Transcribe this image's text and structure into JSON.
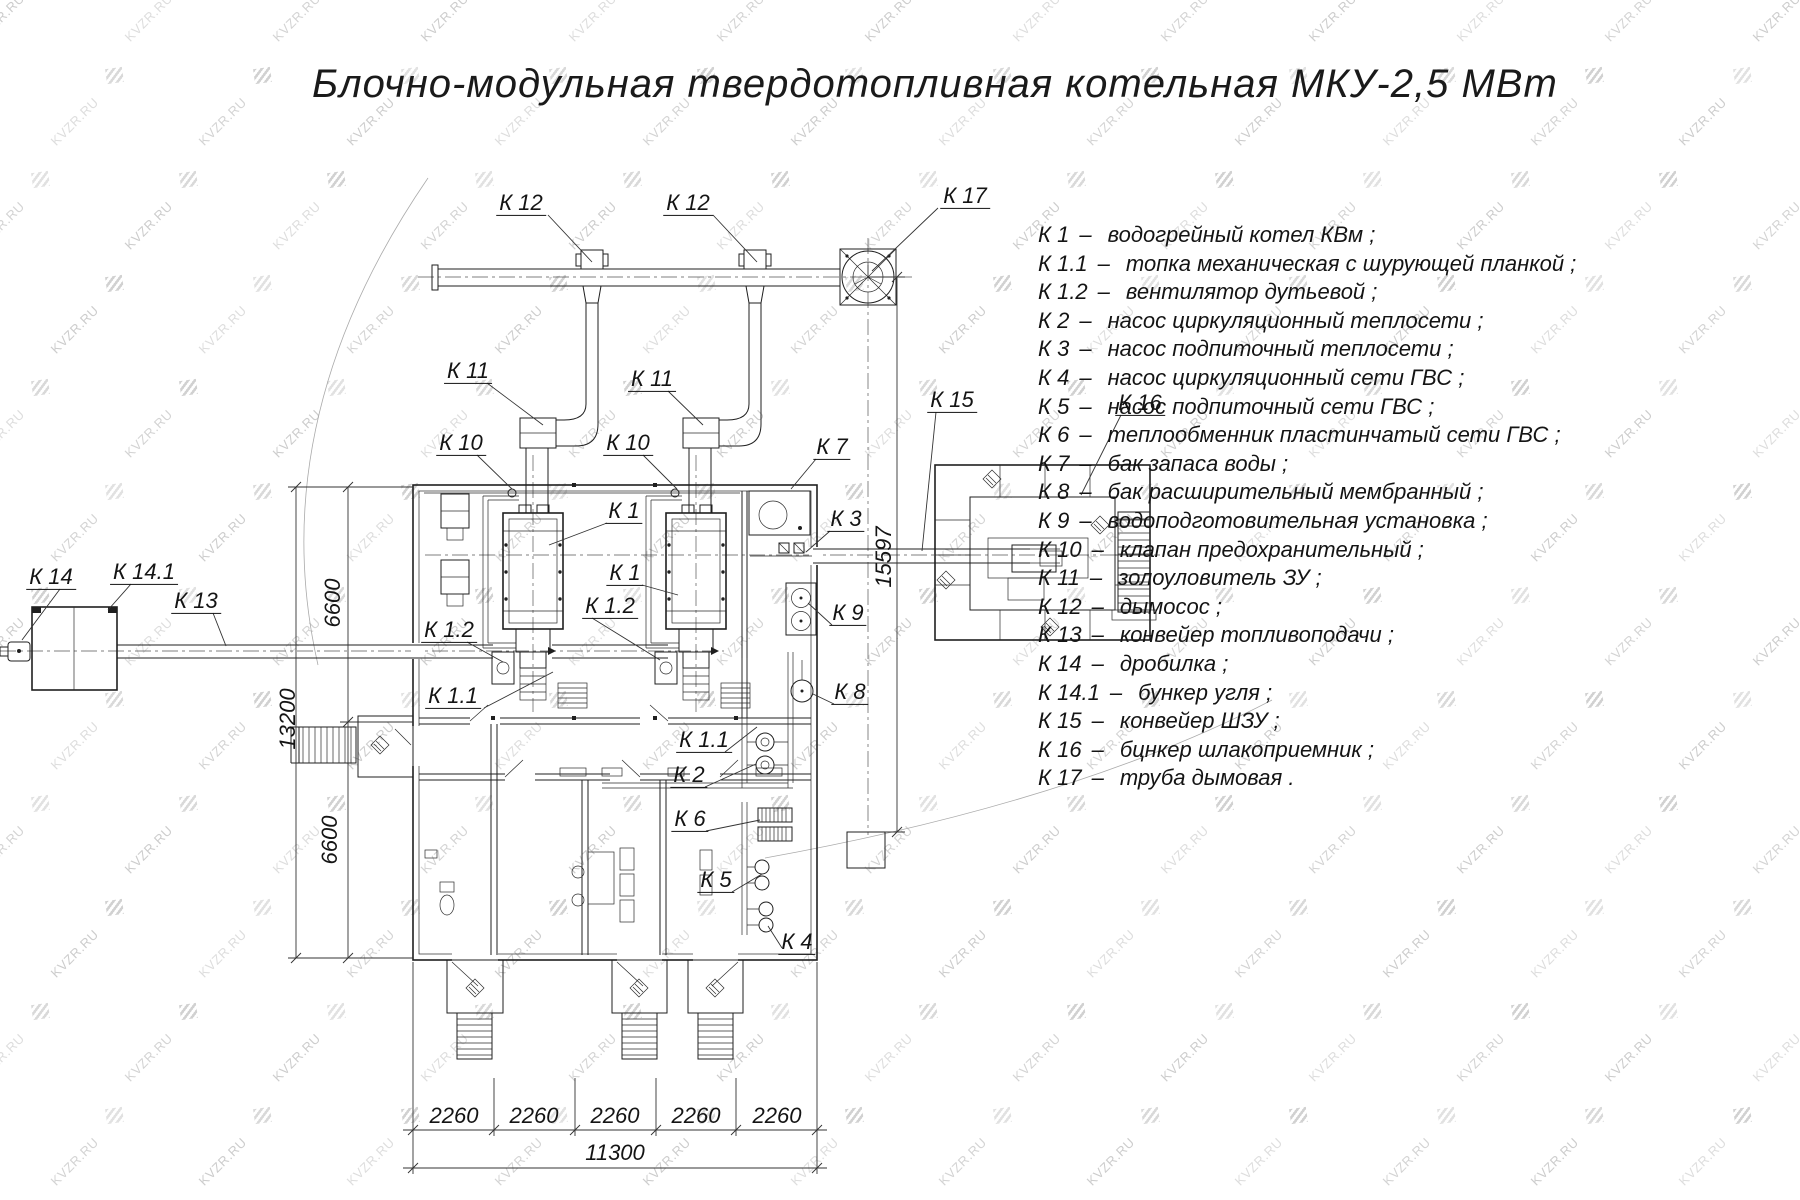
{
  "title": "Блочно-модульная твердотопливная котельная МКУ-2,5 МВт",
  "watermark": {
    "text": "KVZR.RU"
  },
  "colors": {
    "line": "#1f1f1f",
    "watermark": "#c7c7c7",
    "background": "#ffffff"
  },
  "legend": {
    "dash": "–",
    "items": [
      {
        "code": "К 1",
        "label": "водогрейный котел КВм ;"
      },
      {
        "code": "К 1.1",
        "label": "топка механическая с шурующей планкой ;"
      },
      {
        "code": "К 1.2",
        "label": "вентилятор дутьевой ;"
      },
      {
        "code": "К 2",
        "label": "насос циркуляционный теплосети ;"
      },
      {
        "code": "К 3",
        "label": "насос подпиточный теплосети ;"
      },
      {
        "code": "К 4",
        "label": "насос циркуляционный сети ГВС ;"
      },
      {
        "code": "К 5",
        "label": "насос подпиточный сети ГВС ;"
      },
      {
        "code": "К 6",
        "label": "теплообменник пластинчатый сети ГВС ;"
      },
      {
        "code": "К 7",
        "label": "бак запаса воды ;"
      },
      {
        "code": "К 8",
        "label": "бак расширительный мембранный ;"
      },
      {
        "code": "К 9",
        "label": "водоподготовительная установка ;"
      },
      {
        "code": "К 10",
        "label": "клапан предохранительный ;"
      },
      {
        "code": "К 11",
        "label": "золоуловитель ЗУ ;"
      },
      {
        "code": "К 12",
        "label": "дымосос ;"
      },
      {
        "code": "К 13",
        "label": "конвейер топливоподачи ;"
      },
      {
        "code": "К 14",
        "label": "дробилка ;"
      },
      {
        "code": "К 14.1",
        "label": "бункер угля ;"
      },
      {
        "code": "К 15",
        "label": "конвейер ШЗУ ;"
      },
      {
        "code": "К 16",
        "label": "бцнкер шлакоприемник ;"
      },
      {
        "code": "К 17",
        "label": "труба дымовая ."
      }
    ]
  },
  "drawing": {
    "callouts": [
      {
        "text": "К 12",
        "x": 521,
        "y": 204
      },
      {
        "text": "К 12",
        "x": 688,
        "y": 204
      },
      {
        "text": "К 17",
        "x": 965,
        "y": 197
      },
      {
        "text": "К 11",
        "x": 468,
        "y": 372
      },
      {
        "text": "К 11",
        "x": 652,
        "y": 380
      },
      {
        "text": "К 10",
        "x": 461,
        "y": 444
      },
      {
        "text": "К 10",
        "x": 628,
        "y": 444
      },
      {
        "text": "К 7",
        "x": 832,
        "y": 448
      },
      {
        "text": "К 3",
        "x": 846,
        "y": 520
      },
      {
        "text": "К 15",
        "x": 952,
        "y": 401
      },
      {
        "text": "К 16",
        "x": 1140,
        "y": 404
      },
      {
        "text": "К 1",
        "x": 624,
        "y": 512
      },
      {
        "text": "К 1",
        "x": 625,
        "y": 574
      },
      {
        "text": "К 1.2",
        "x": 610,
        "y": 607
      },
      {
        "text": "К 1.2",
        "x": 449,
        "y": 631
      },
      {
        "text": "К 9",
        "x": 848,
        "y": 614
      },
      {
        "text": "К 8",
        "x": 850,
        "y": 693
      },
      {
        "text": "К 1.1",
        "x": 453,
        "y": 697
      },
      {
        "text": "К 1.1",
        "x": 704,
        "y": 741
      },
      {
        "text": "К 2",
        "x": 689,
        "y": 776
      },
      {
        "text": "К 6",
        "x": 690,
        "y": 820
      },
      {
        "text": "К 5",
        "x": 716,
        "y": 881
      },
      {
        "text": "К 4",
        "x": 797,
        "y": 943
      },
      {
        "text": "К 14",
        "x": 51,
        "y": 578
      },
      {
        "text": "К 14.1",
        "x": 144,
        "y": 573
      },
      {
        "text": "К 13",
        "x": 196,
        "y": 602
      }
    ],
    "dimensions": [
      {
        "text": "6600",
        "x": 333,
        "y": 603,
        "rot": true
      },
      {
        "text": "13200",
        "x": 288,
        "y": 719,
        "rot": true
      },
      {
        "text": "6600",
        "x": 330,
        "y": 840,
        "rot": true
      },
      {
        "text": "15597",
        "x": 884,
        "y": 557,
        "rot": true
      },
      {
        "text": "2260",
        "x": 454,
        "y": 1116,
        "rot": false
      },
      {
        "text": "2260",
        "x": 534,
        "y": 1116,
        "rot": false
      },
      {
        "text": "2260",
        "x": 615,
        "y": 1116,
        "rot": false
      },
      {
        "text": "2260",
        "x": 696,
        "y": 1116,
        "rot": false
      },
      {
        "text": "2260",
        "x": 777,
        "y": 1116,
        "rot": false
      },
      {
        "text": "11300",
        "x": 615,
        "y": 1153,
        "rot": false
      }
    ]
  }
}
